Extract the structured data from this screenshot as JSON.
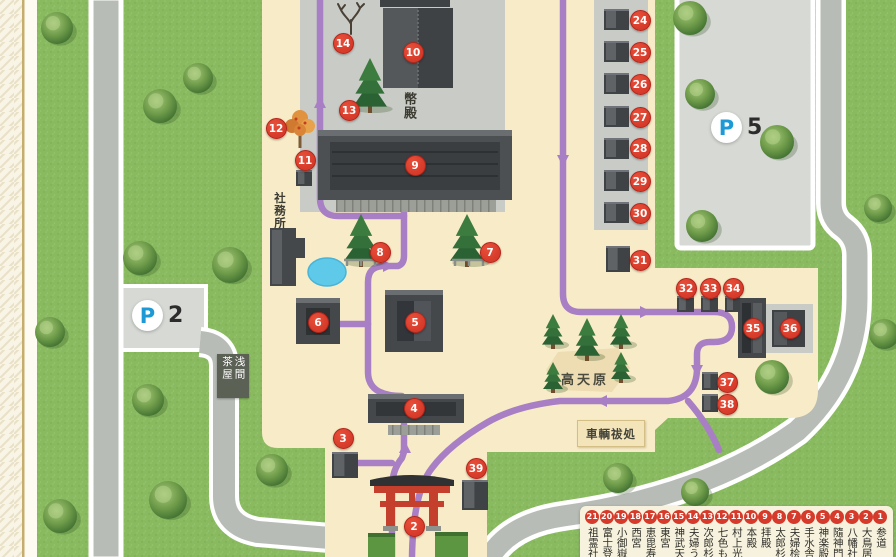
{
  "map": {
    "labels": {
      "heiden": "幣殿",
      "shamusho": "社務所",
      "sengen_chaya": {
        "right": "浅間",
        "left": "茶屋"
      },
      "takamagahara": "高天原",
      "sharyo_haraisho": "車輌祓処"
    },
    "parking": [
      {
        "letter": "P",
        "number": "2"
      },
      {
        "letter": "P",
        "number": "5"
      }
    ],
    "colors": {
      "marker_red": "#d63a2a",
      "path_purple": "#a87fc4",
      "parking_blue": "#1d9ad6",
      "grass_green": "#89ba60",
      "grounds_beige": "#f8ecc8",
      "road_gray": "#b8bcb6",
      "pond_blue": "#5ec9e9",
      "torii_red": "#c4402d"
    },
    "markers": [
      {
        "n": 2,
        "x": 414,
        "y": 526
      },
      {
        "n": 3,
        "x": 343,
        "y": 438
      },
      {
        "n": 4,
        "x": 414,
        "y": 408
      },
      {
        "n": 5,
        "x": 415,
        "y": 322
      },
      {
        "n": 6,
        "x": 318,
        "y": 322
      },
      {
        "n": 7,
        "x": 490,
        "y": 252
      },
      {
        "n": 8,
        "x": 380,
        "y": 252
      },
      {
        "n": 9,
        "x": 415,
        "y": 165
      },
      {
        "n": 10,
        "x": 413,
        "y": 52
      },
      {
        "n": 11,
        "x": 305,
        "y": 160
      },
      {
        "n": 12,
        "x": 276,
        "y": 128
      },
      {
        "n": 13,
        "x": 349,
        "y": 110
      },
      {
        "n": 14,
        "x": 343,
        "y": 43
      },
      {
        "n": 24,
        "x": 640,
        "y": 20
      },
      {
        "n": 25,
        "x": 640,
        "y": 52
      },
      {
        "n": 26,
        "x": 640,
        "y": 84
      },
      {
        "n": 27,
        "x": 640,
        "y": 117
      },
      {
        "n": 28,
        "x": 640,
        "y": 148
      },
      {
        "n": 29,
        "x": 640,
        "y": 181
      },
      {
        "n": 30,
        "x": 640,
        "y": 213
      },
      {
        "n": 31,
        "x": 640,
        "y": 260
      },
      {
        "n": 32,
        "x": 686,
        "y": 288
      },
      {
        "n": 33,
        "x": 710,
        "y": 288
      },
      {
        "n": 34,
        "x": 733,
        "y": 288
      },
      {
        "n": 35,
        "x": 753,
        "y": 328
      },
      {
        "n": 36,
        "x": 790,
        "y": 328
      },
      {
        "n": 37,
        "x": 727,
        "y": 382
      },
      {
        "n": 38,
        "x": 727,
        "y": 404
      },
      {
        "n": 39,
        "x": 476,
        "y": 468
      }
    ]
  },
  "legend": {
    "items": [
      {
        "number": "1",
        "label": "参道"
      },
      {
        "number": "2",
        "label": "大鳥居"
      },
      {
        "number": "3",
        "label": "八幡社"
      },
      {
        "number": "4",
        "label": "隨神門"
      },
      {
        "number": "5",
        "label": "神楽殿"
      },
      {
        "number": "6",
        "label": "手水舎"
      },
      {
        "number": "7",
        "label": "夫婦桧"
      },
      {
        "number": "8",
        "label": "太郎杉"
      },
      {
        "number": "9",
        "label": "拝殿"
      },
      {
        "number": "10",
        "label": "本殿"
      },
      {
        "number": "11",
        "label": "村上光清"
      },
      {
        "number": "12",
        "label": "七色も"
      },
      {
        "number": "13",
        "label": "次郎杉"
      },
      {
        "number": "14",
        "label": "夫婦う"
      },
      {
        "number": "15",
        "label": "神武天"
      },
      {
        "number": "16",
        "label": "東宮"
      },
      {
        "number": "17",
        "label": "恵毘寿"
      },
      {
        "number": "18",
        "label": "西宮"
      },
      {
        "number": "19",
        "label": "小御嶽"
      },
      {
        "number": "20",
        "label": "富士登"
      },
      {
        "number": "21",
        "label": "祖霊社"
      }
    ]
  }
}
